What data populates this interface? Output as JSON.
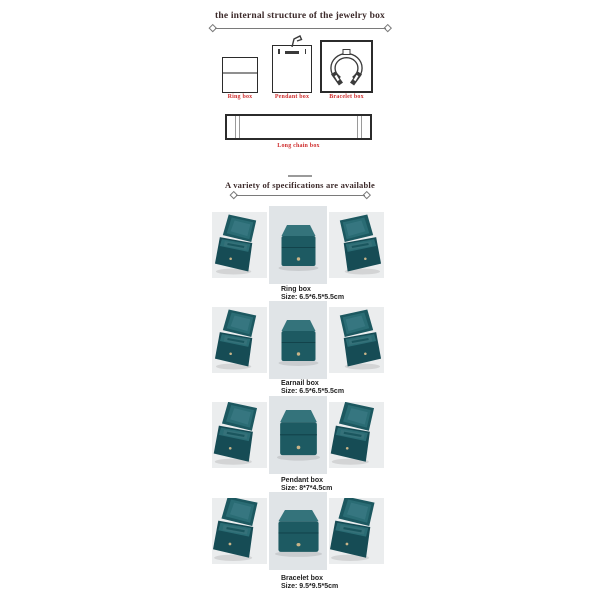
{
  "header": {
    "title": "the internal structure of the jewelry box"
  },
  "structure_section": {
    "items": [
      {
        "label": "Ring box"
      },
      {
        "label": "Pendant box"
      },
      {
        "label": "Bracelet box"
      },
      {
        "label": "Long chain box"
      }
    ]
  },
  "spec_section": {
    "title": "A variety of specifications are available"
  },
  "products": [
    {
      "name": "Ring box",
      "size": "Size: 6.5*6.5*5.5cm"
    },
    {
      "name": "Earnail box",
      "size": "Size: 6.5*6.5*5.5cm"
    },
    {
      "name": "Pendant box",
      "size": "Size: 8*7*4.5cm"
    },
    {
      "name": "Bracelet box",
      "size": "Size: 9.5*9.5*5cm"
    }
  ],
  "icons": {
    "ring_box_diagram": "square-with-slot",
    "pendant_box_diagram": "rect-with-hook-and-bar",
    "bracelet_box_diagram": "square-with-open-bangle",
    "long_chain_box_diagram": "wide-rect-with-end-dividers"
  },
  "colors": {
    "heading_text": "#3c2a2a",
    "diagram_label_red": "#cf2e2e",
    "product_text": "#1f1f1f",
    "box_teal_dark": "#1d5a62",
    "box_teal_light": "#34737b",
    "photo_bg_side": "#ebedee",
    "photo_bg_middle": "#e0e4e7"
  }
}
